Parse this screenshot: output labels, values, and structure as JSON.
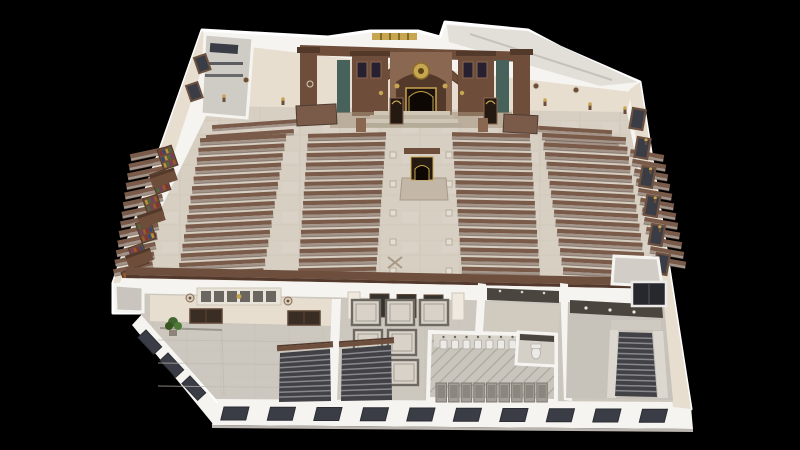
{
  "scene": {
    "kind": "3d-cutaway-floorplan-render",
    "subject": "ornate synagogue interior, top-down axonometric cutaway, no visible text",
    "background_color": "#000000"
  },
  "palette": {
    "bg": "#000000",
    "wall_white": "#f6f4f0",
    "wall_shadow": "#d8d4cd",
    "cream_wall": "#e7ded0",
    "cream_dark": "#d6ccba",
    "floor_main": "#d6cfc2",
    "floor_light": "#e4ded2",
    "floor_lower": "#cdc8bf",
    "floor_gray": "#c5c1b9",
    "pew_back": "#7a5b4a",
    "pew_seat": "#a3948a",
    "pew_dark": "#4f3c33",
    "wood_dark": "#53392a",
    "wood_mid": "#6e4e3a",
    "wood_light": "#8a6750",
    "marble_green": "#47625a",
    "gold": "#c8a550",
    "ark_dark": "#1d130c",
    "window_dark": "#3b3d46",
    "window_frame": "#6d5140",
    "stair_dark": "#414146",
    "stair_tread": "#8f8f96",
    "rail_brown": "#6e4f3e",
    "tile_line": "#6e6a63",
    "stall_gray": "#a39e96",
    "fixture_white": "#eceae6",
    "plant_green": "#41662e",
    "glass_yellow": "#e6c53a",
    "dark_band": "#4a463f",
    "book_colors": [
      "#8a3030",
      "#2e4a7a",
      "#b8933f",
      "#4a6b3a",
      "#7a3a6a",
      "#9a5a28"
    ]
  },
  "sanctuary": {
    "pew_banks": [
      {
        "id": "left-wall",
        "x": 130,
        "top_y": 150,
        "width": 40,
        "rows": 13,
        "row_gap": 9.6,
        "tilt_deg": -12,
        "x_shift_per_row": -1.4
      },
      {
        "id": "left-outer",
        "x": 200,
        "top_y": 136,
        "width": 86,
        "rows": 15,
        "row_gap": 9.6,
        "tilt_deg": -3,
        "x_shift_per_row": -1.6
      },
      {
        "id": "left-center",
        "x": 308,
        "top_y": 133,
        "width": 78,
        "rows": 15,
        "row_gap": 9.6,
        "tilt_deg": -1.2,
        "x_shift_per_row": -0.7
      },
      {
        "id": "right-center",
        "x": 452,
        "top_y": 133,
        "width": 78,
        "rows": 15,
        "row_gap": 9.6,
        "tilt_deg": 1.2,
        "x_shift_per_row": 0.7
      },
      {
        "id": "right-outer",
        "x": 542,
        "top_y": 135,
        "width": 84,
        "rows": 15,
        "row_gap": 9.6,
        "tilt_deg": 3,
        "x_shift_per_row": 1.5
      },
      {
        "id": "right-wall",
        "x": 630,
        "top_y": 152,
        "width": 34,
        "rows": 12,
        "row_gap": 9.7,
        "tilt_deg": 10,
        "x_shift_per_row": 2.0
      }
    ],
    "front_benches": [
      {
        "x": 212,
        "y": 122,
        "w": 88,
        "tilt": -4
      },
      {
        "x": 206,
        "y": 132,
        "w": 88,
        "tilt": -4
      },
      {
        "x": 538,
        "y": 128,
        "w": 74,
        "tilt": 3.5
      },
      {
        "x": 545,
        "y": 138,
        "w": 74,
        "tilt": 3.5
      }
    ],
    "box_pews": [
      {
        "x": 296,
        "y": 106,
        "w": 40,
        "h": 20,
        "tilt": -3
      },
      {
        "x": 504,
        "y": 114,
        "w": 34,
        "h": 18,
        "tilt": 3
      }
    ],
    "right_windows": {
      "count": 6,
      "start_x": 633,
      "start_y": 108,
      "step_x": 4.8,
      "step_y": 29,
      "w": 13,
      "h": 20,
      "tilt": 10
    },
    "right_sconces": {
      "count": 4,
      "start_x": 646,
      "start_y": 140,
      "step_x": 4.6,
      "step_y": 29
    },
    "bookshelves": {
      "count": 6,
      "start_x": 157,
      "start_y": 150,
      "step_x": -7.2,
      "step_y": 24.5,
      "w": 15,
      "h": 21,
      "tilt": -19
    },
    "gallery_boxes": [
      {
        "x": 149,
        "y": 176,
        "w": 26,
        "h": 13
      },
      {
        "x": 137,
        "y": 216,
        "w": 26,
        "h": 13
      },
      {
        "x": 125,
        "y": 256,
        "w": 26,
        "h": 13
      }
    ],
    "left_windows": [
      {
        "x": 194,
        "y": 58
      },
      {
        "x": 186,
        "y": 86
      }
    ],
    "wall_sconces": [
      [
        224,
        96
      ],
      [
        283,
        99
      ],
      [
        545,
        100
      ],
      [
        590,
        104
      ],
      [
        625,
        108
      ]
    ],
    "wall_rosettes": [
      [
        246,
        80
      ],
      [
        310,
        84
      ],
      [
        536,
        86
      ],
      [
        576,
        90
      ]
    ],
    "glass_strip": {
      "x": 372,
      "y": 33,
      "w": 45,
      "h": 7,
      "mullions": 4
    },
    "aisle_pedestals": {
      "count": 5,
      "start_y": 152,
      "step_y": 29,
      "x_left": 390,
      "x_right": 446,
      "size": 6
    },
    "floor_inlay_x": [
      [
        388,
        257
      ]
    ]
  },
  "lower_level": {
    "lobby": {
      "doors": [
        {
          "x": 190,
          "y": 309,
          "w": 32,
          "h": 14
        },
        {
          "x": 288,
          "y": 311,
          "w": 32,
          "h": 14
        }
      ],
      "coffer_panel": {
        "x": 197,
        "y": 288,
        "w": 84,
        "h": 17
      },
      "medallions": [
        [
          190,
          298
        ],
        [
          288,
          301
        ]
      ],
      "floor_lines_y": [
        340,
        363,
        386
      ],
      "plant": {
        "x": 173,
        "y": 322
      }
    },
    "corridor_tiles": {
      "origin_x": 352,
      "origin_y": 300,
      "step_x": 34,
      "step_y": 30,
      "w": 28,
      "h": 25,
      "cells": [
        [
          0,
          0
        ],
        [
          0,
          1
        ],
        [
          1,
          0
        ],
        [
          1,
          1
        ],
        [
          1,
          2
        ],
        [
          2,
          0
        ]
      ]
    },
    "porch": {
      "doors": {
        "count": 3,
        "start_x": 370,
        "y": 294,
        "step_x": 27,
        "w": 19,
        "h": 23
      },
      "pilasters": [
        [
          348,
          292
        ],
        [
          452,
          293
        ]
      ]
    },
    "restroom": {
      "urinals": {
        "count": 8,
        "start_x": 440,
        "y": 337,
        "step_x": 11.5
      },
      "stalls": {
        "count": 9,
        "start_x": 436,
        "y": 383,
        "step_x": 12.6,
        "w": 10.5,
        "h": 19
      }
    },
    "stairs": [
      {
        "id": "lobby-stair",
        "x1": 280,
        "y1": 353,
        "x2": 330,
        "y2": 349,
        "x3": 331,
        "y3": 401,
        "x4": 279,
        "y4": 402,
        "treads": 9,
        "rail": true
      },
      {
        "id": "corridor-stair",
        "x1": 342,
        "y1": 349,
        "x2": 391,
        "y2": 345,
        "x3": 392,
        "y3": 400,
        "x4": 341,
        "y4": 401,
        "treads": 9,
        "rail": true
      },
      {
        "id": "main-stairwell",
        "x1": 619,
        "y1": 332,
        "x2": 652,
        "y2": 333,
        "x3": 657,
        "y3": 397,
        "x4": 615,
        "y4": 396,
        "treads": 11,
        "rail": false
      }
    ],
    "hall_lights": [
      [
        586,
        308
      ],
      [
        610,
        310
      ],
      [
        634,
        312
      ]
    ],
    "vestibule_lights": [
      [
        500,
        291
      ],
      [
        522,
        292
      ],
      [
        544,
        293
      ]
    ],
    "facade_windows": {
      "count": 10,
      "start_x": 224,
      "step_x": 46.5,
      "y": 407,
      "w": 25,
      "h": 13,
      "skew": -14
    },
    "diagonal_windows": {
      "count": 3,
      "start_x": 146,
      "start_y": 330,
      "step_x": 22,
      "step_y": 23,
      "w": 23,
      "h": 11,
      "tilt": 47
    }
  }
}
